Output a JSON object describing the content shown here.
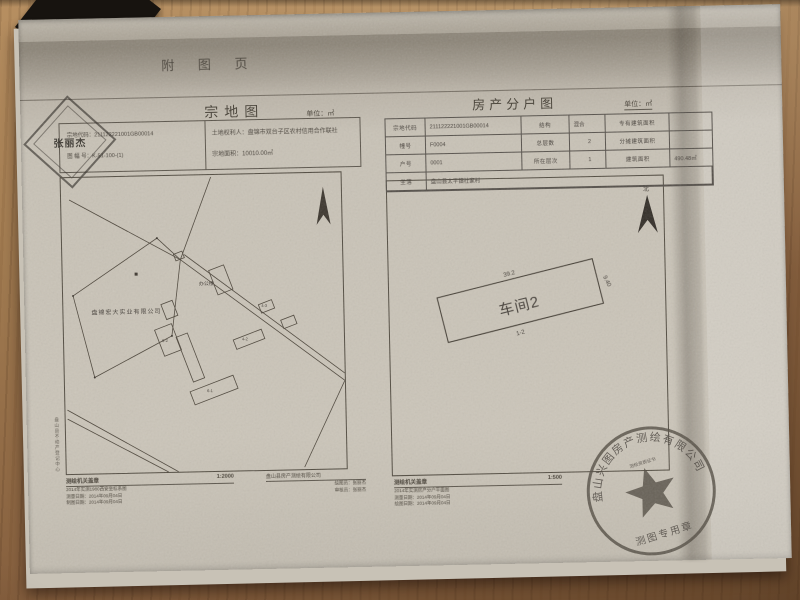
{
  "page": {
    "corner_note": "附 图 页"
  },
  "left_map": {
    "title": "宗地图",
    "unit": "单位：㎡",
    "info": {
      "code_label": "宗地代码：",
      "code": "211122221001GB00014",
      "sheet_label": "图 幅 号：",
      "sheet": "K-51-100-(1)",
      "holder_label": "土地权利人：",
      "holder": "盘锦市双台子区农村信用合作联社",
      "area_label": "宗地面积：",
      "area": "10010.00㎡"
    },
    "name_stamp": "张丽杰",
    "map_labels": {
      "company": "盘锦宏大实业有限公司",
      "office": "办公楼",
      "b1": "6-2",
      "b2": "6-1",
      "b3": "4-2",
      "b4": "4-3"
    },
    "footer": {
      "agency": "测绘机关盖章",
      "scale": "1:2000",
      "line1": "2014年实测1980西安坐标系图",
      "line2": "测量日期：2014年09月04日",
      "line3": "制图日期：2014年09月04日"
    },
    "maker": {
      "company": "盘山县房产测绘有限公司",
      "drafter": "绘图员：张丽杰",
      "checker": "审核员：张丽杰"
    },
    "side_note": "盘山县不动产登记中心"
  },
  "right_map": {
    "title": "房产分户图",
    "unit": "单位：㎡",
    "table": {
      "rows": [
        [
          "宗地代码",
          "211122221001GB00014",
          "结构",
          "混合",
          "专有建筑面积",
          ""
        ],
        [
          "幢号",
          "F0004",
          "总层数",
          "2",
          "分摊建筑面积",
          ""
        ],
        [
          "户号",
          "0001",
          "所在层次",
          "1",
          "建筑面积",
          "490.48㎡"
        ],
        [
          "坐落",
          "盘山县太平镇社家村"
        ]
      ]
    },
    "north_label": "北",
    "building": {
      "name": "车间2",
      "length": "39.2",
      "width": "9.40",
      "floors": "1-2"
    },
    "footer": {
      "agency": "测绘机关盖章",
      "scale": "1:500",
      "line1": "2014年实测房产分户平面图",
      "line2": "测量日期：2014年09月04日",
      "line3": "绘图日期：2014年09月04日"
    }
  },
  "seal": {
    "company": "盘山兴图房产测绘有限公司",
    "middle": "测绘资质证书",
    "type": "测图专用章"
  }
}
